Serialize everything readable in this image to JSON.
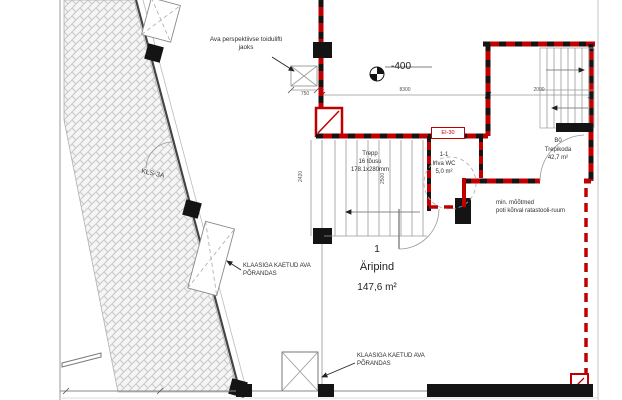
{
  "plan": {
    "level_marker": "-400",
    "wall_label": "KLS-3A",
    "fire_door_label": "EI-30",
    "food_lift_note": {
      "l1": "Ava perspektiivse toidulifti",
      "l2": "jaoks"
    },
    "stairs_left": {
      "l1": "Trepp",
      "l2": "16 tõusu",
      "l3": "178.1x280mm"
    },
    "wc_room": {
      "l1": "1-1",
      "l2": "Inva WC",
      "l3": "5,0 m²"
    },
    "stairwell_room": {
      "l1": "B0",
      "l2": "Trepikoda",
      "l3": "42,7 m²"
    },
    "main_room": {
      "number": "1",
      "name": "Äripind",
      "area": "147,6 m²"
    },
    "glass_note_mid": {
      "l1": "KLAASIGA KAETUD AVA",
      "l2": "PÕRANDAS"
    },
    "glass_note_bottom": {
      "l1": "KLAASIGA KAETUD AVA",
      "l2": "PÕRANDAS"
    },
    "wc_note": {
      "l1": "min. mõõtmed",
      "l2": "poti kõrval ratastooli-ruum"
    },
    "dims": {
      "top_left": "8300",
      "top_right": "2000",
      "lift": "750",
      "stair_side": "2420",
      "wc_side": "2500"
    },
    "colors": {
      "wall_red": "#c00000",
      "structure_black": "#141414",
      "hatch_line": "#c8c8c8",
      "thin_line": "#8a8a8a"
    }
  }
}
